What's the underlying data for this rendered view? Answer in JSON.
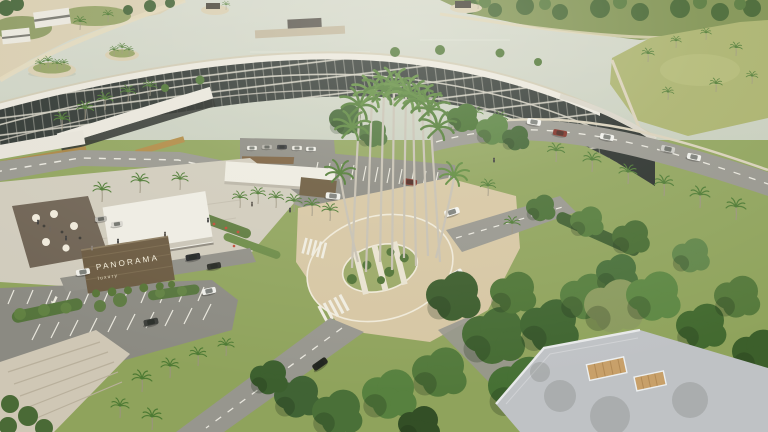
{
  "meta": {
    "title": "Panorama resort aerial rendering",
    "type": "architectural-visualization"
  },
  "signage": {
    "name": "PANORAMA",
    "tagline": "luxury"
  },
  "scene": {
    "description": "Aerial view of a lakeside resort: a long curved low-rise apartment building with dark balconies and a white slab roof beside a pale lagoon with palm islands, a landscaped roundabout with tall royal palms, an entrance pavilion with a timber logo wall, guest parking with painted arrows, palm-lined roads and dense tropical forest.",
    "features": [
      "lagoon",
      "palm islands",
      "waterfront villas",
      "curved apartment building",
      "roof planters",
      "entrance pavilion",
      "logo wall",
      "terrace",
      "roundabout",
      "royal palms",
      "parking lot",
      "palm-lined roads",
      "tropical forest",
      "flat roof with timber decks"
    ]
  },
  "colors": {
    "water": "#ccd1c4",
    "sand": "#d8cdb0",
    "shoreGreen": "#7d904f",
    "field": "#a9b16c",
    "facade": "#2f3632",
    "roofWhite": "#eae7dd",
    "road": "#97968e",
    "asphalt": "#8b8a82",
    "paving": "#d6c6a3",
    "plaza": "#d0cbbc",
    "grass": "#8fa35c",
    "signWood": "#6a5940",
    "signText": "#f2ecd9",
    "roofGrey": "#bfc2c5",
    "deckWood": "#c8a069",
    "flowerRed": "#bf4a36",
    "carDarkRed": "#7e2c22"
  }
}
